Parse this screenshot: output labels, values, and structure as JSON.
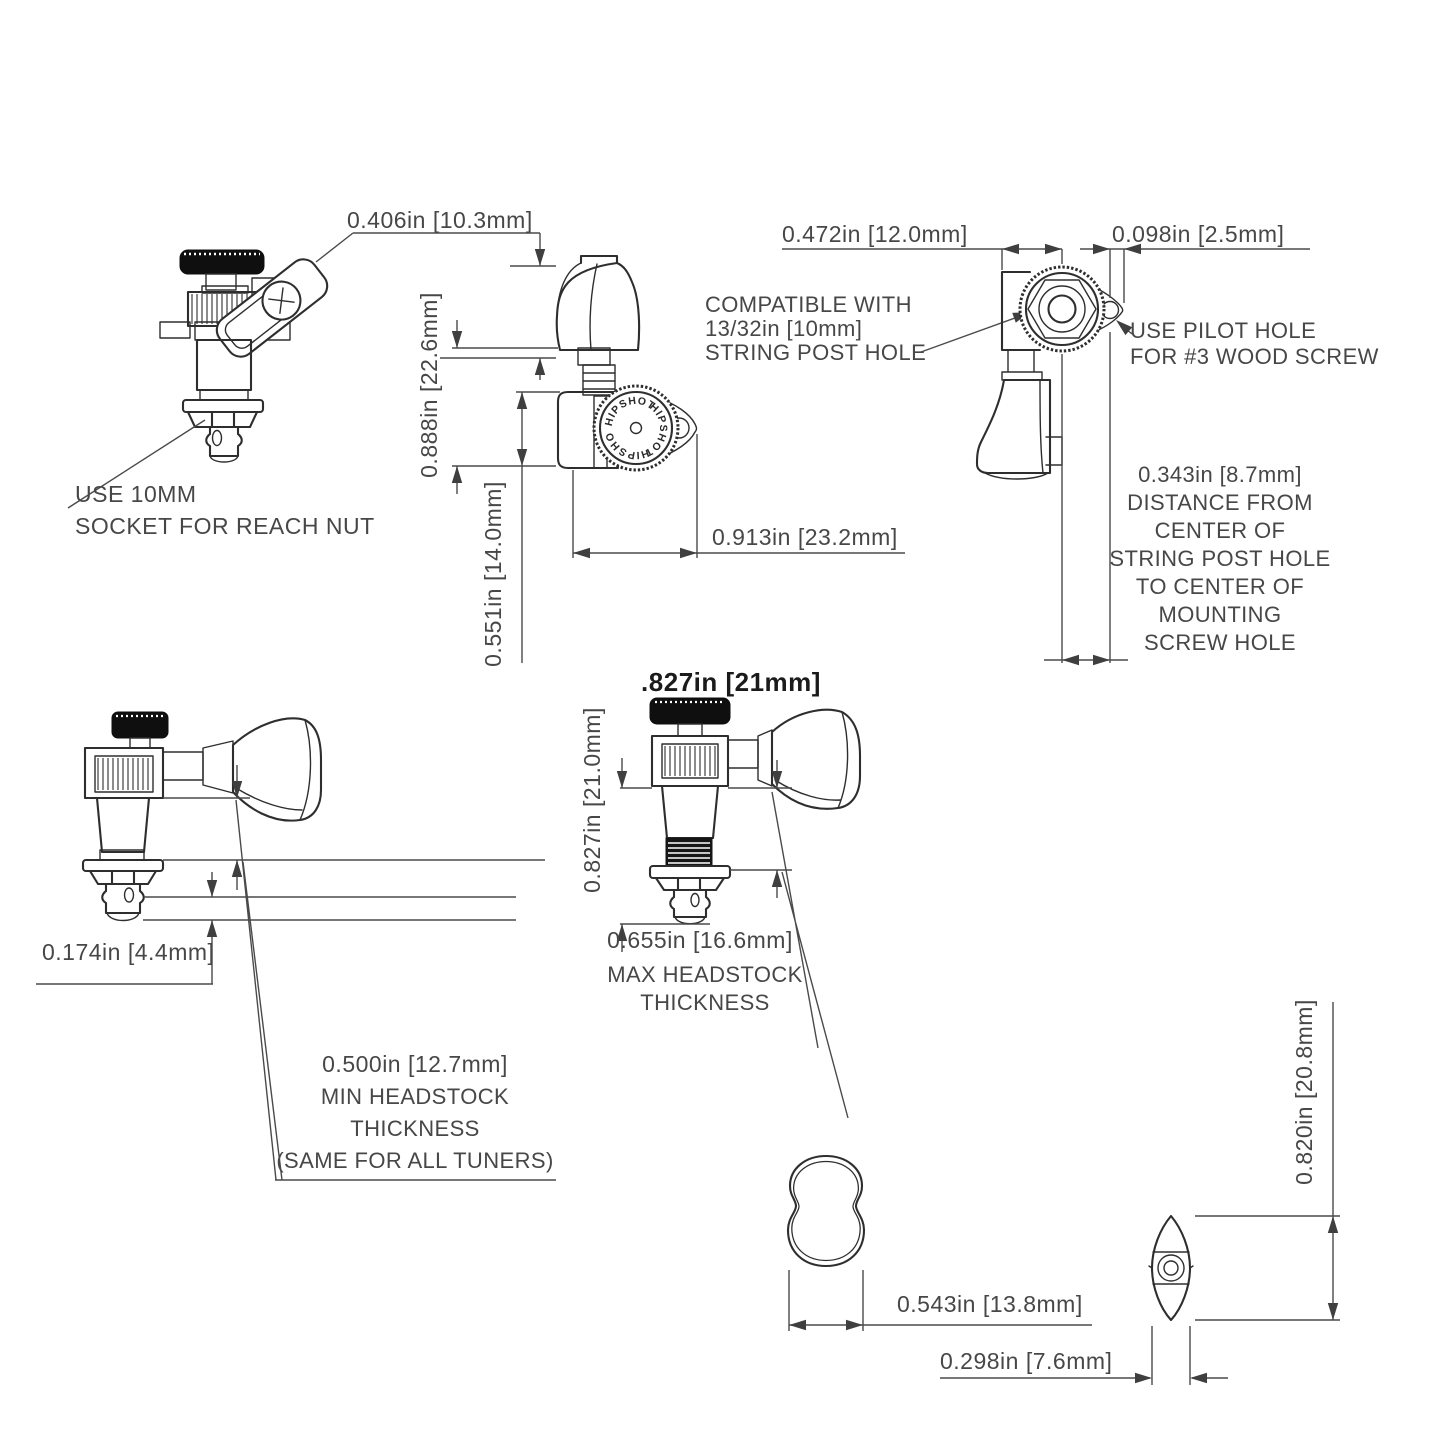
{
  "colors": {
    "outline": "#2e2e2e",
    "dimension": "#4a4a4a",
    "text": "#474747",
    "knob_fill": "#0f0f0f",
    "background": "#ffffff"
  },
  "brand": {
    "gear_text": "HIPSHOT"
  },
  "dimensions": {
    "plate_width": "0.406in [10.3mm]",
    "knob_to_base": "0.888in [22.6mm]",
    "housing_height": "0.551in [14.0mm]",
    "body_length": "0.913in [23.2mm]",
    "edge_to_post": "0.472in [12.0mm]",
    "ear_edge": "0.098in [2.5mm]",
    "post_tip": "0.174in [4.4mm]",
    "overall_title": ".827in [21mm]",
    "overall_height": "0.827in [21.0mm]",
    "button_width": "0.543in [13.8mm]",
    "button_thickness": "0.298in [7.6mm]",
    "button_height": "0.820in [20.8mm]"
  },
  "callouts": {
    "socket": {
      "lines": [
        "USE 10MM",
        "SOCKET FOR REACH NUT"
      ]
    },
    "compatible": {
      "lines": [
        "COMPATIBLE WITH",
        "13/32in [10mm]",
        "STRING POST HOLE"
      ]
    },
    "pilot": {
      "lines": [
        "USE PILOT HOLE",
        "FOR #3 WOOD SCREW"
      ]
    },
    "screw_offset": {
      "lines": [
        "0.343in [8.7mm]",
        "DISTANCE FROM",
        "CENTER OF",
        "STRING POST HOLE",
        "TO CENTER OF",
        "MOUNTING",
        "SCREW HOLE"
      ]
    },
    "max_headstock": {
      "lines": [
        "0.655in [16.6mm]",
        "MAX HEADSTOCK",
        "THICKNESS"
      ]
    },
    "min_headstock": {
      "lines": [
        "0.500in [12.7mm]",
        "MIN HEADSTOCK",
        "THICKNESS",
        "(SAME FOR ALL TUNERS)"
      ]
    }
  }
}
